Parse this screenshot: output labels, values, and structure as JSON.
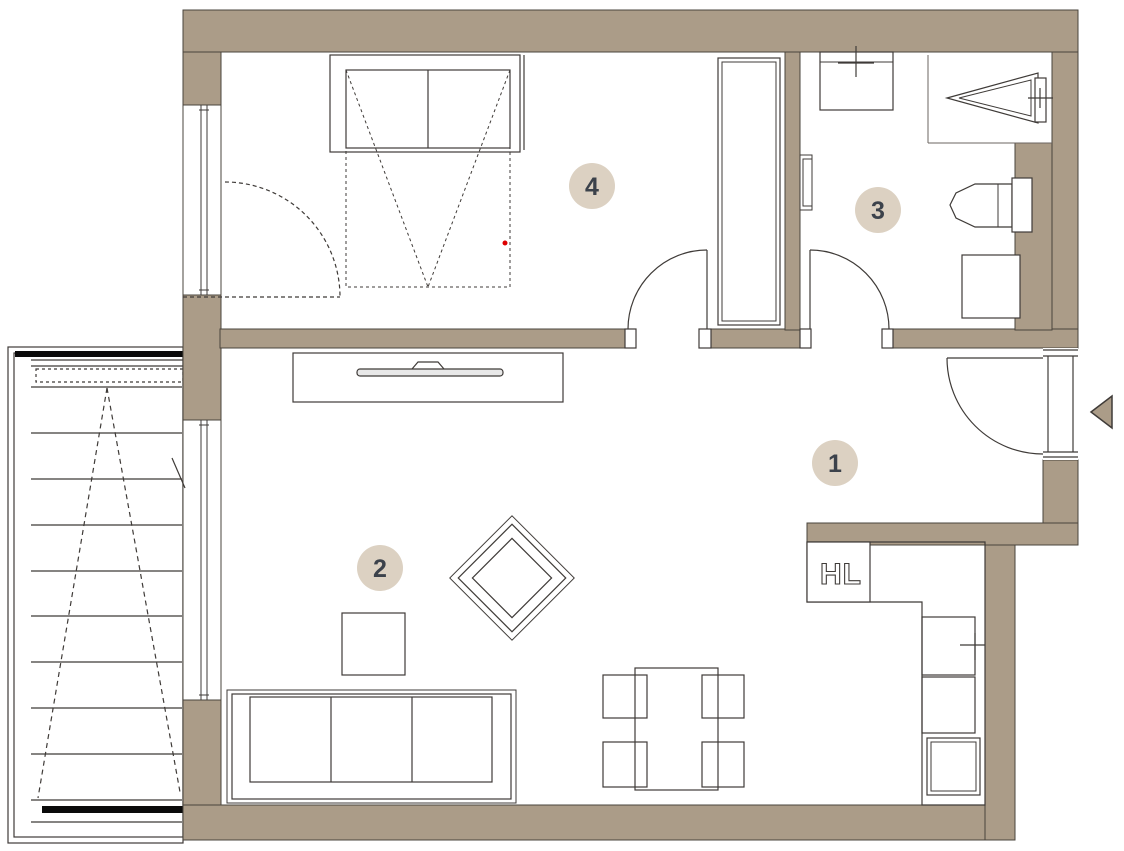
{
  "canvas": {
    "width": 1124,
    "height": 851
  },
  "colors": {
    "background": "#ffffff",
    "wall_fill": "#ab9c88",
    "wall_outline": "#4a443c",
    "line": "#3f3b38",
    "thin_line": "#6b6560",
    "label_circle_fill": "#dcd1c2",
    "label_text": "#3c424b",
    "red_marker": "#dd0000",
    "stair_bar": "#0a0a0a"
  },
  "rooms": [
    {
      "label": "1"
    },
    {
      "label": "2"
    },
    {
      "label": "3"
    },
    {
      "label": "4"
    }
  ],
  "kitchen": {
    "shaft_label": "HL"
  },
  "icons": {
    "entrance_arrow": "left-pointing-triangle"
  }
}
